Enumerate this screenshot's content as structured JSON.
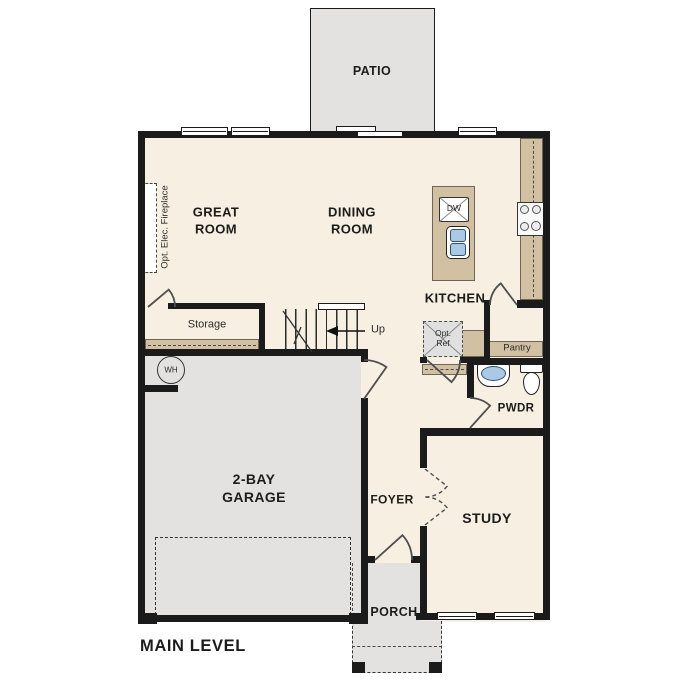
{
  "title": "MAIN LEVEL",
  "colors": {
    "floor": "#f6efe2",
    "hard": "#e3e2e1",
    "counter": "#d2c0a3",
    "wall": "#1b1b1b",
    "blue": "#a9c9e6",
    "appliance": "#e0e0e0"
  },
  "rooms": {
    "patio": {
      "label": "PATIO"
    },
    "great_room": {
      "label": "GREAT\nROOM"
    },
    "dining_room": {
      "label": "DINING\nROOM"
    },
    "kitchen": {
      "label": "KITCHEN"
    },
    "storage": {
      "label": "Storage"
    },
    "pantry": {
      "label": "Pantry"
    },
    "powder": {
      "label": "PWDR"
    },
    "garage": {
      "label": "2-BAY\nGARAGE"
    },
    "foyer": {
      "label": "FOYER"
    },
    "study": {
      "label": "STUDY"
    },
    "porch": {
      "label": "PORCH"
    }
  },
  "annotations": {
    "stairs_up": "Up",
    "opt_fireplace": "Opt. Elec. Fireplace",
    "opt_ref": "Opt.\nRef",
    "dishwasher": "DW",
    "water_heater": "WH"
  }
}
